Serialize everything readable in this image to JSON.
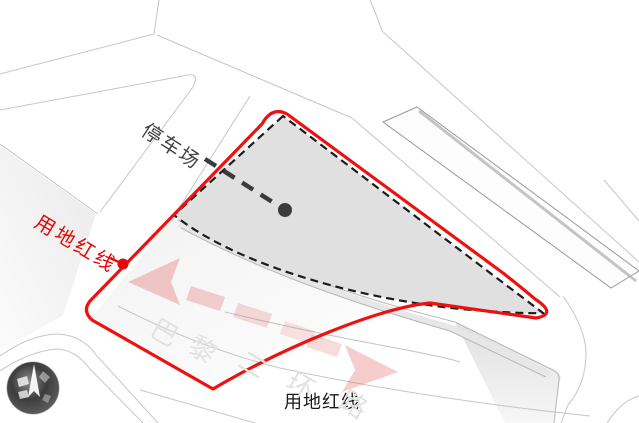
{
  "diagram": {
    "type": "architectural-site-plan",
    "labels": {
      "parking": "停车场",
      "red_line_left": "用地红线",
      "red_line_bottom": "用地红线",
      "road_name": "巴黎二环路",
      "road_chars": [
        "巴",
        "黎",
        "二",
        "环",
        "路"
      ]
    },
    "colors": {
      "boundary_red": "#ee1111",
      "site_fill": "#e0e0e0",
      "outline_dash_black": "#1c1c1c",
      "road_line_gray": "#c6c6c6",
      "road_text_gray": "#e2e2e2",
      "traffic_arrow_pink": "#e05a5a",
      "leader_dark_gray": "#3b3b3b"
    },
    "icons": {
      "compass": "compass-icon"
    }
  }
}
